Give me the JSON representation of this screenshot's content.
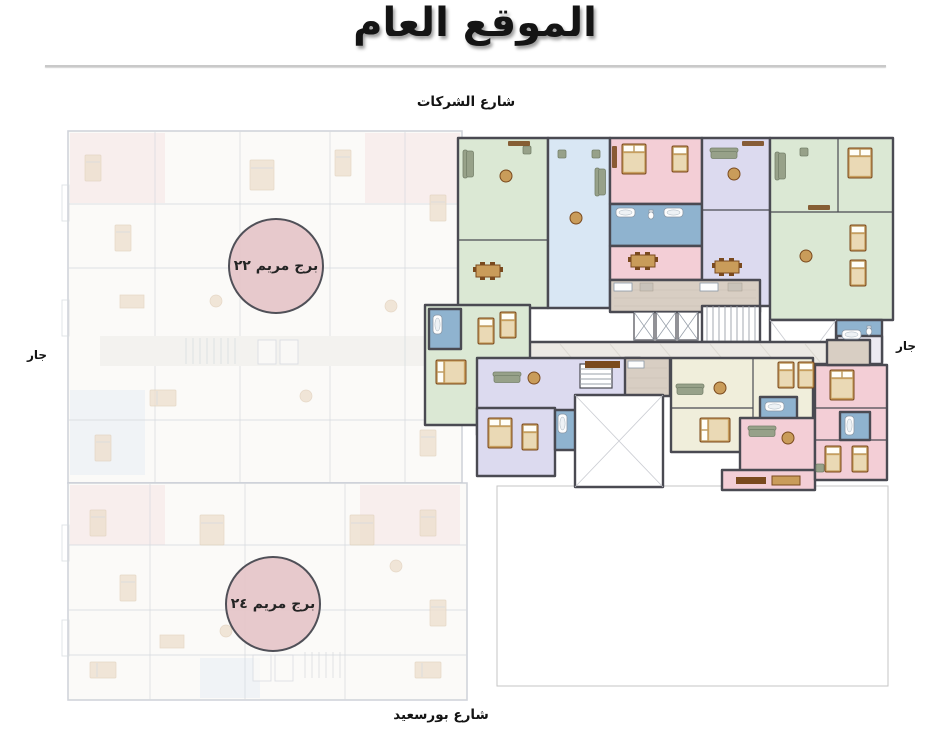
{
  "page": {
    "title": "الموقع العام",
    "language": "ar",
    "direction": "rtl"
  },
  "labels": {
    "street_top": "شارع الشركات",
    "street_bottom": "شارع بورسعيد",
    "neighbor_left": "جار",
    "neighbor_right": "جار"
  },
  "towers": [
    {
      "id": "maryam-22",
      "label": "برج مريم ٢٢"
    },
    {
      "id": "maryam-24",
      "label": "برج مريم ٢٤"
    }
  ],
  "palette": {
    "text": "#1a1a1a",
    "divider": "#c9c9c9",
    "wall": "#4a4a52",
    "unit-green": "#dbe8d4",
    "unit-blue": "#d9e7f4",
    "unit-pink": "#f3ced6",
    "unit-lavender": "#dcdaef",
    "unit-cream": "#f0eedb",
    "bath-blue": "#8fb3cf",
    "tile-beige": "#d8cec3",
    "corridor": "#ece9e4",
    "wood": "#7a4a1e",
    "wood-light": "#c99c5a",
    "cushion": "#ead9b5",
    "sofa": "#97a189",
    "circle-fill": "#e6c6c9",
    "faded-line": "#c9cdd5",
    "faded-fill": "#fbfaf8",
    "faded-furn": "#eee0cf"
  }
}
